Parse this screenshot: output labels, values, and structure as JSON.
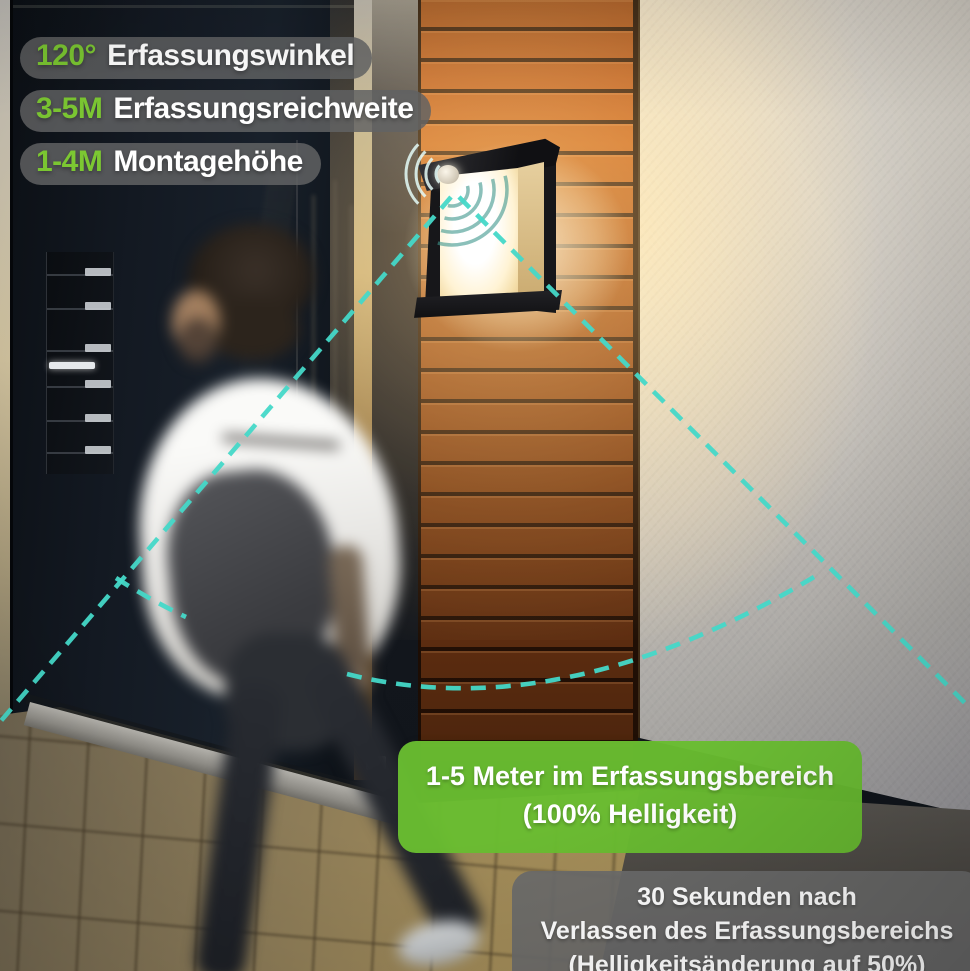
{
  "colors": {
    "accent_green": "#7cc832",
    "active_box_green": "#69bd31",
    "cone_teal": "#45d8c8",
    "pill_gray": "#626364",
    "timeout_box_gray": "#6a6a6a",
    "wood_orange": "#b4571c",
    "wall_gray": "#ccc8c0"
  },
  "spec_labels": [
    {
      "value": "120°",
      "label": "Erfassungswinkel"
    },
    {
      "value": "3-5M",
      "label": "Erfassungsreichweite"
    },
    {
      "value": "1-4M",
      "label": "Montagehöhe"
    }
  ],
  "callouts": {
    "in_range": {
      "line1": "1-5 Meter im Erfassungsbereich",
      "line2": "(100% Helligkeit)"
    },
    "after_leave": {
      "line1": "30 Sekunden nach",
      "line2": "Verlassen des Erfassungsbereichs",
      "line3": "(Helligkeitsänderung auf 50%)"
    }
  }
}
